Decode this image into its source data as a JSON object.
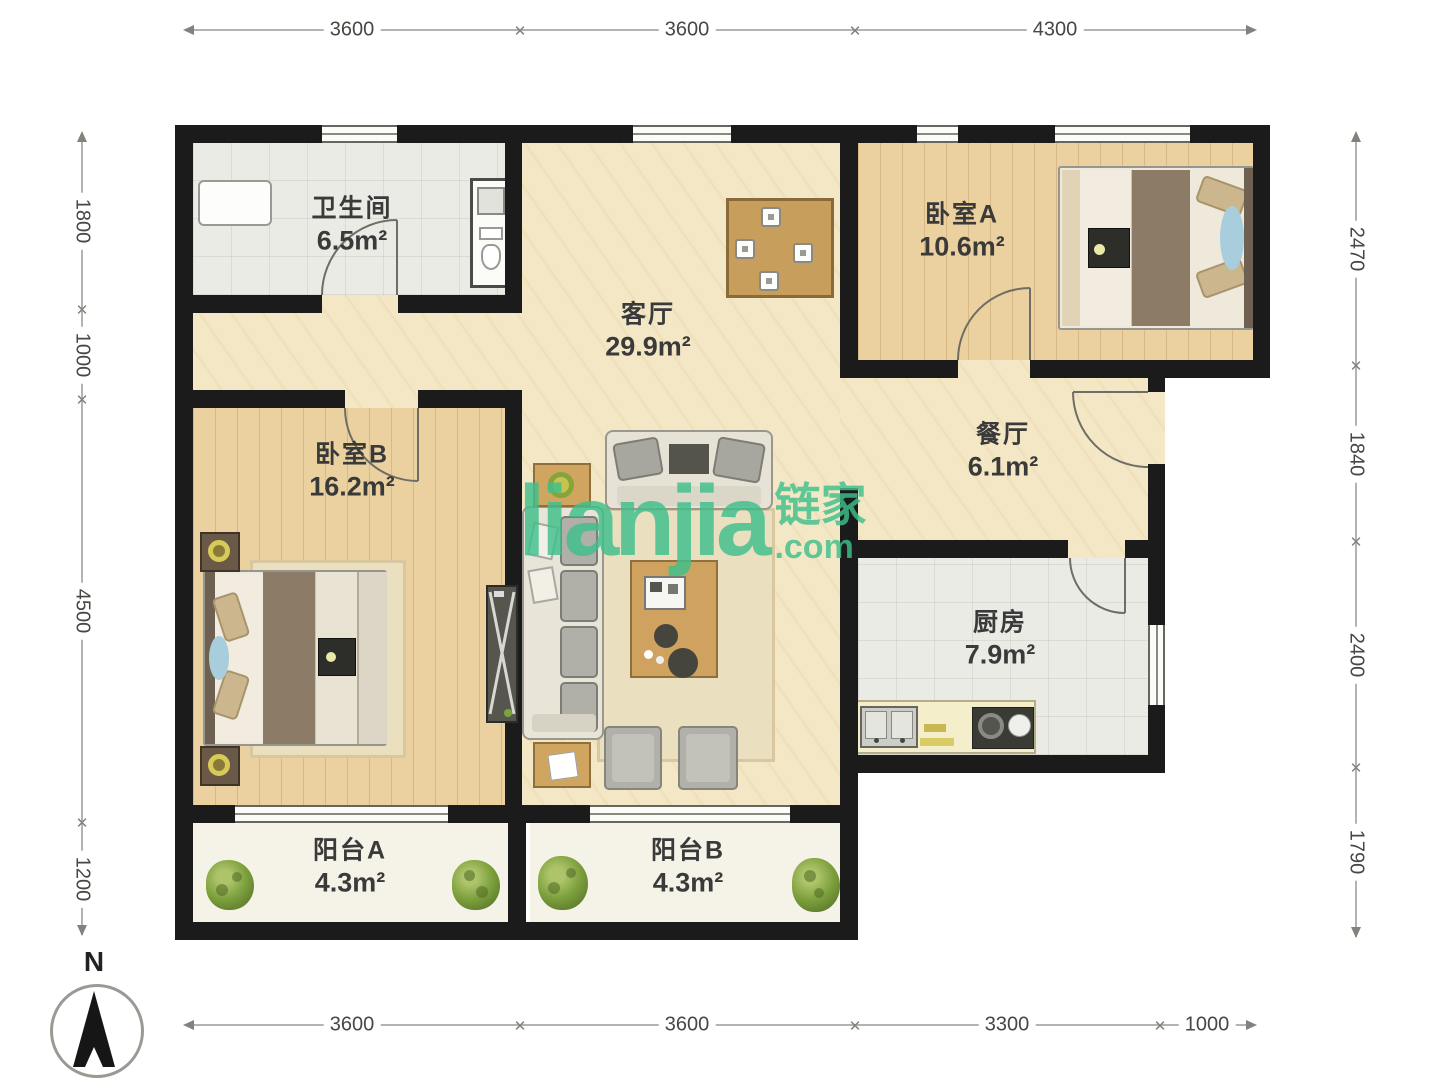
{
  "rooms": [
    {
      "name": "卫生间",
      "area": "6.5m²"
    },
    {
      "name": "客厅",
      "area": "29.9m²"
    },
    {
      "name": "卧室A",
      "area": "10.6m²"
    },
    {
      "name": "餐厅",
      "area": "6.1m²"
    },
    {
      "name": "卧室B",
      "area": "16.2m²"
    },
    {
      "name": "厨房",
      "area": "7.9m²"
    },
    {
      "name": "阳台A",
      "area": "4.3m²"
    },
    {
      "name": "阳台B",
      "area": "4.3m²"
    }
  ],
  "dimensions": {
    "top": [
      "3600",
      "3600",
      "4300"
    ],
    "bottom": [
      "3600",
      "3600",
      "3300",
      "1000"
    ],
    "left": [
      "1800",
      "1000",
      "4500",
      "1200"
    ],
    "right": [
      "2470",
      "1840",
      "2400",
      "1790"
    ]
  },
  "watermark": {
    "brand": "lianjia",
    "brand_cn": "链家",
    "domain": ".com",
    "color": "#3fc08c"
  },
  "compass": {
    "north_label": "N"
  }
}
